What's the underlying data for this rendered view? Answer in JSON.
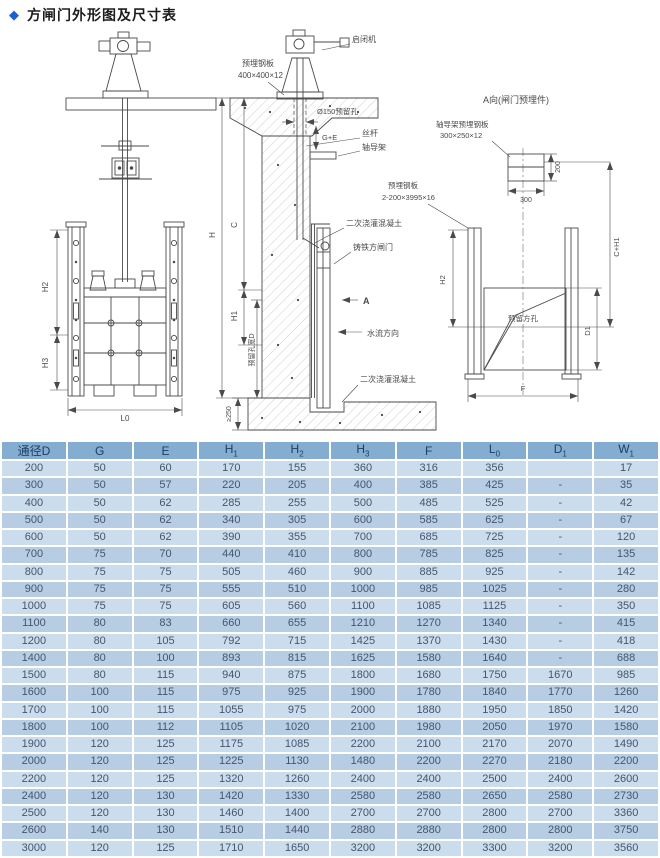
{
  "page": {
    "bullet": "◆",
    "title": "方闸门外形图及尺寸表"
  },
  "colors": {
    "accent_diamond": "#1b5fd2",
    "table_header_bg": "#85acd1",
    "table_header_text": "#1e3f63",
    "row_light": "#cbdcec",
    "row_dark": "#b6cde3",
    "cell_text": "#44566c",
    "drawing_line": "#4a4a4a"
  },
  "drawing": {
    "labels": {
      "hoist": "启闭机",
      "plate1a": "预埋钢板",
      "plate1b": "400×400×12",
      "hole150": "Ø150预留孔",
      "screw": "丝杆",
      "guide": "轴导架",
      "concrete2": "二次浇灌混凝土",
      "gate": "铸铁方闸门",
      "flow": "水流方向",
      "section_a": "A",
      "view_title": "A向(闸门预埋件)",
      "guide_plate_a": "轴导架预埋钢板",
      "guide_plate_b": "300×250×12",
      "plate2a": "预埋钢板",
      "plate2b": "2-200×3995×16",
      "square_hole": "预留方孔",
      "hole_width": "预留孔宽D",
      "min250": "≥250"
    },
    "dims": {
      "h": "H",
      "c": "C",
      "h1": "H1",
      "h2": "H2",
      "h3": "H3",
      "l0": "L0",
      "f": "F",
      "d1": "D1",
      "ch1": "C+H1",
      "w300": "300",
      "h200": "200",
      "ge": "G+E"
    }
  },
  "table": {
    "columns": [
      {
        "base": "通径D",
        "sub": ""
      },
      {
        "base": "G",
        "sub": ""
      },
      {
        "base": "E",
        "sub": ""
      },
      {
        "base": "H",
        "sub": "1"
      },
      {
        "base": "H",
        "sub": "2"
      },
      {
        "base": "H",
        "sub": "3"
      },
      {
        "base": "F",
        "sub": ""
      },
      {
        "base": "L",
        "sub": "0"
      },
      {
        "base": "D",
        "sub": "1"
      },
      {
        "base": "W",
        "sub": "1"
      }
    ],
    "rows": [
      [
        200,
        50,
        60,
        170,
        155,
        360,
        316,
        356,
        "",
        17
      ],
      [
        300,
        50,
        57,
        220,
        205,
        400,
        385,
        425,
        "-",
        35
      ],
      [
        400,
        50,
        62,
        285,
        255,
        500,
        485,
        525,
        "-",
        42
      ],
      [
        500,
        50,
        62,
        340,
        305,
        600,
        585,
        625,
        "-",
        67
      ],
      [
        600,
        50,
        62,
        390,
        355,
        700,
        685,
        725,
        "-",
        120
      ],
      [
        700,
        75,
        70,
        440,
        410,
        800,
        785,
        825,
        "-",
        135
      ],
      [
        800,
        75,
        75,
        505,
        460,
        900,
        885,
        925,
        "-",
        142
      ],
      [
        900,
        75,
        75,
        555,
        510,
        1000,
        985,
        1025,
        "-",
        280
      ],
      [
        1000,
        75,
        75,
        605,
        560,
        1100,
        1085,
        1125,
        "-",
        350
      ],
      [
        1100,
        80,
        83,
        660,
        655,
        1210,
        1270,
        1340,
        "-",
        415
      ],
      [
        1200,
        80,
        105,
        792,
        715,
        1425,
        1370,
        1430,
        "-",
        418
      ],
      [
        1400,
        80,
        100,
        893,
        815,
        1625,
        1580,
        1640,
        "-",
        688
      ],
      [
        1500,
        80,
        115,
        940,
        875,
        1800,
        1680,
        1750,
        1670,
        985
      ],
      [
        1600,
        100,
        115,
        975,
        925,
        1900,
        1780,
        1840,
        1770,
        1260
      ],
      [
        1700,
        100,
        115,
        1055,
        975,
        2000,
        1880,
        1950,
        1850,
        1420
      ],
      [
        1800,
        100,
        112,
        1105,
        1020,
        2100,
        1980,
        2050,
        1970,
        1580
      ],
      [
        1900,
        120,
        125,
        1175,
        1085,
        2200,
        2100,
        2170,
        2070,
        1490
      ],
      [
        2000,
        120,
        125,
        1225,
        1130,
        1480,
        2200,
        2270,
        2180,
        2200
      ],
      [
        2200,
        120,
        125,
        1320,
        1260,
        2400,
        2400,
        2500,
        2400,
        2600
      ],
      [
        2400,
        120,
        130,
        1420,
        1330,
        2580,
        2580,
        2650,
        2580,
        2730
      ],
      [
        2500,
        120,
        130,
        1460,
        1400,
        2700,
        2700,
        2800,
        2700,
        3360
      ],
      [
        2600,
        140,
        130,
        1510,
        1440,
        2880,
        2880,
        2800,
        2800,
        3750
      ],
      [
        3000,
        120,
        125,
        1710,
        1650,
        3200,
        3200,
        3300,
        3200,
        3560
      ]
    ]
  }
}
